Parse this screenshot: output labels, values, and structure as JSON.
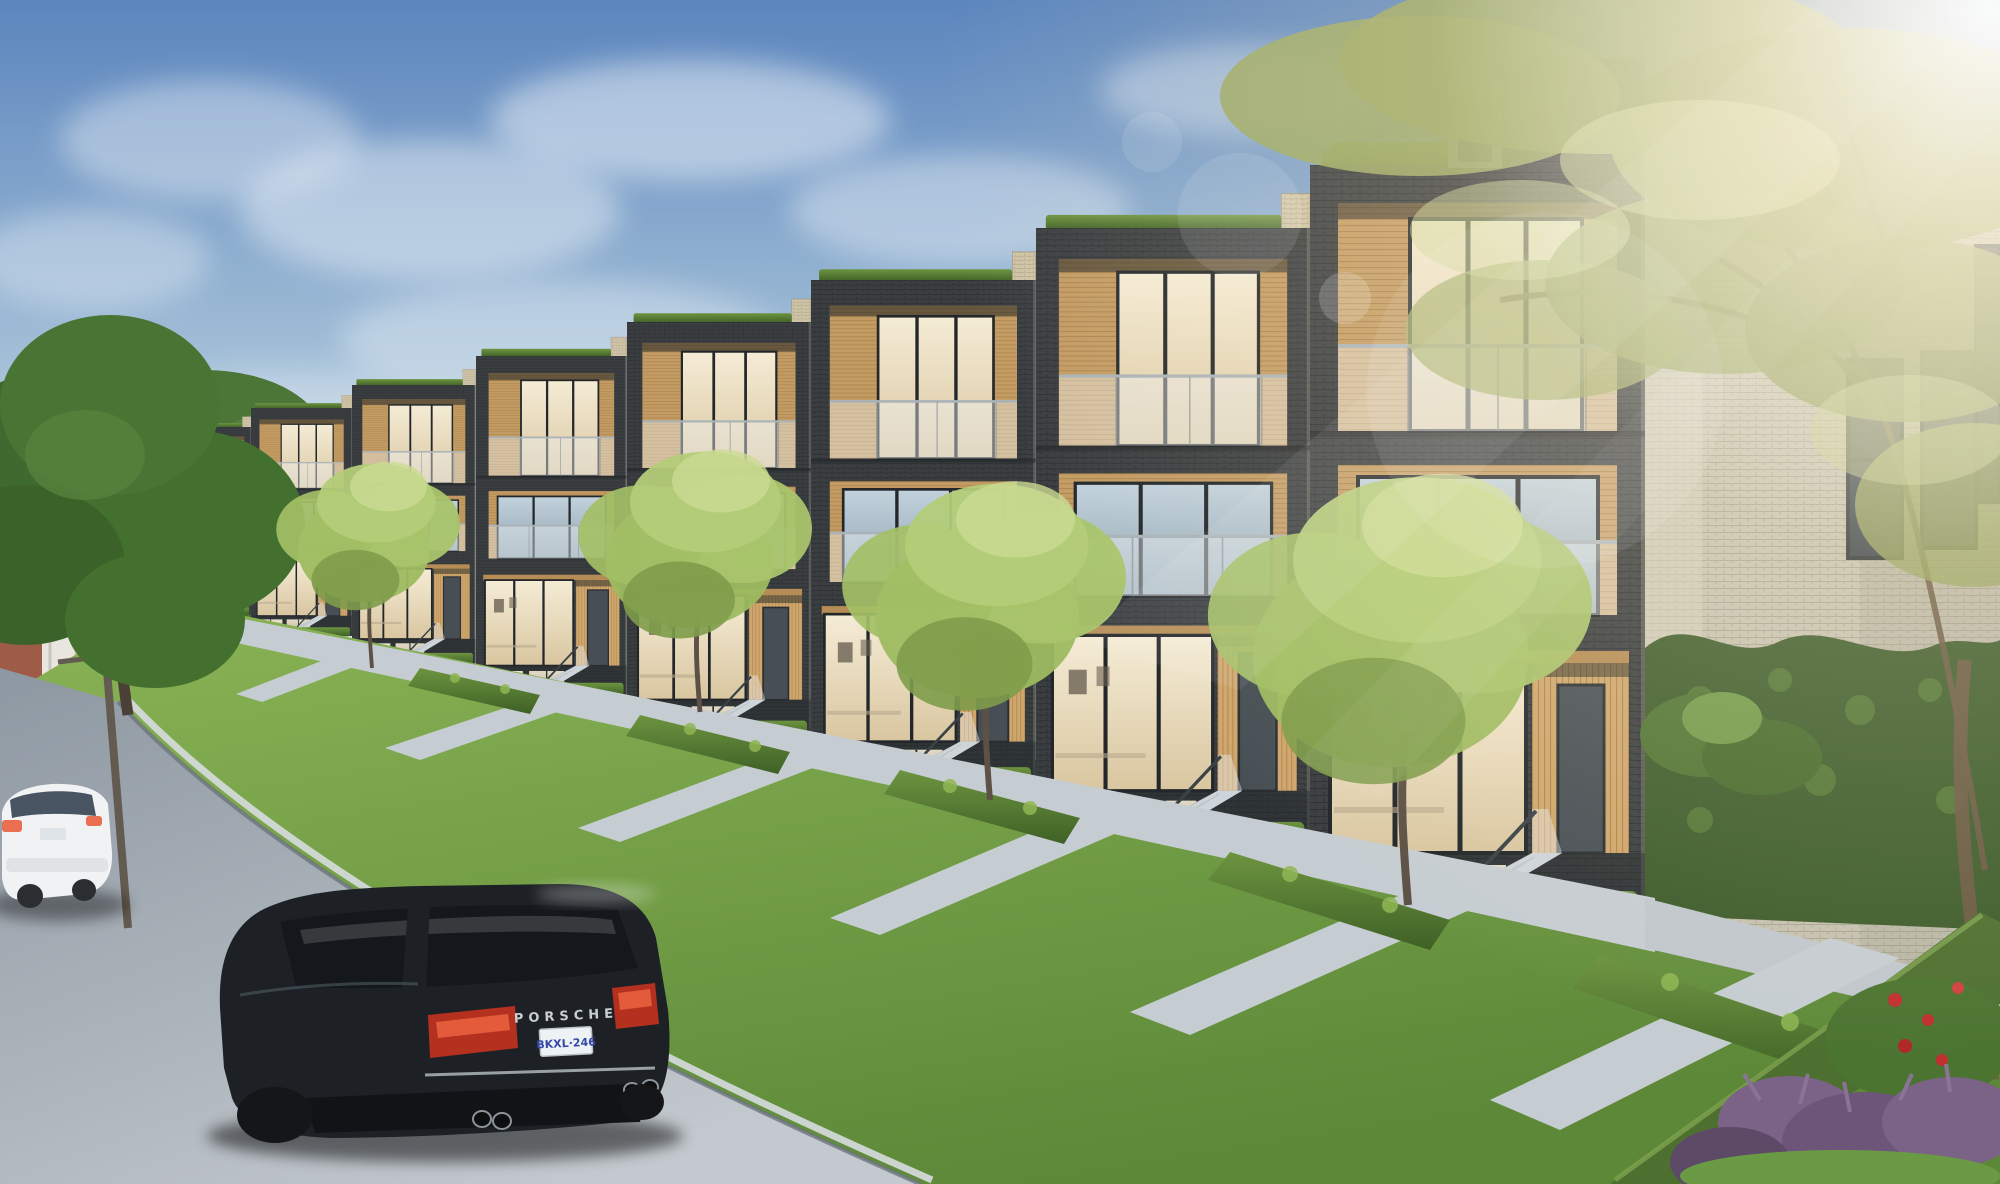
{
  "image": {
    "kind": "architectural exterior rendering",
    "description": "Modern four-storey dark-brick townhouse row on a sunny day; landscaped front yards with clipped hedges and young trees; light-brick end wall with ivy; black Porsche SUV and white sedan parked on the street; sun glare and lens flare from upper right",
    "width_px": 2000,
    "height_px": 1184
  },
  "texts": {
    "suv_badge": "PORSCHE",
    "suv_plate": "BKXL·246"
  },
  "scene": {
    "objects": [
      {
        "name": "sky",
        "label": "hazy blue sky with soft clouds"
      },
      {
        "name": "sun-glare",
        "label": "bright sunlight from top right with lens flare circles"
      },
      {
        "name": "townhouse-row",
        "label": "stepped row of 8 dark charcoal brick townhouse units, 4 storeys, recessed wood-lined balconies with glass railings, rooftop hedges"
      },
      {
        "name": "end-wall",
        "label": "light grey brick end wall with dark windows and ivy"
      },
      {
        "name": "front-yards",
        "label": "lawns, hedge planters, concrete walkways and entry stairs"
      },
      {
        "name": "street",
        "label": "asphalt street with curb running diagonally lower left"
      },
      {
        "name": "suv",
        "label": "black Porsche Cayenne, rear view, parked at curb"
      },
      {
        "name": "sedan",
        "label": "white sedan parked further up the street"
      },
      {
        "name": "street-trees",
        "label": "young light-green ornamental trees"
      },
      {
        "name": "left-tree",
        "label": "large dark green tree at left"
      },
      {
        "name": "right-tree",
        "label": "large backlit olive tree overhanging from top right"
      },
      {
        "name": "distant-house",
        "label": "red brick house with white porch in left distance"
      },
      {
        "name": "utility-pole",
        "label": "wooden utility pole at left"
      },
      {
        "name": "corner-garden",
        "label": "hedge, red flowers and purple plants at bottom right"
      }
    ]
  },
  "colors": {
    "sky_top": "#5b85bd",
    "sky_mid": "#9fbcd6",
    "sky_horizon": "#dfe9f0",
    "cloud": "#ffffff",
    "dark_brick": "#383c3f",
    "dark_brick_mortar": "#2b2f31",
    "wood_accent": "#c39b63",
    "beige_brick": "#cfc4a7",
    "light_brick": "#c6c2b1",
    "interior_warm": "#f0e6cd",
    "glass_cool": "#b4c6d3",
    "glass_dark": "#3c454c",
    "grass": "#679441",
    "hedge": "#4d7030",
    "tree_light": "#a9c46c",
    "tree_dark": "#44702f",
    "tree_olive": "#97a45f",
    "ivy": "#3d5c2c",
    "walkway": "#c6cdd2",
    "asphalt_far": "#8e98a2",
    "asphalt_near": "#c3c9ce",
    "suv_body": "#1d2125",
    "suv_glass": "#14181c",
    "taillight": "#b5311f",
    "taillight_bright": "#e8603e",
    "chrome": "#aeb6bc",
    "plate_bg": "#eef2f5",
    "plate_text": "#3448a8",
    "badge_text": "#c9ced3",
    "sedan_body": "#f0f2f4",
    "sedan_glass": "#3a4754",
    "house_brick": "#9e5b48",
    "purple_plant": "#7a6387",
    "flower_red": "#c03030"
  }
}
